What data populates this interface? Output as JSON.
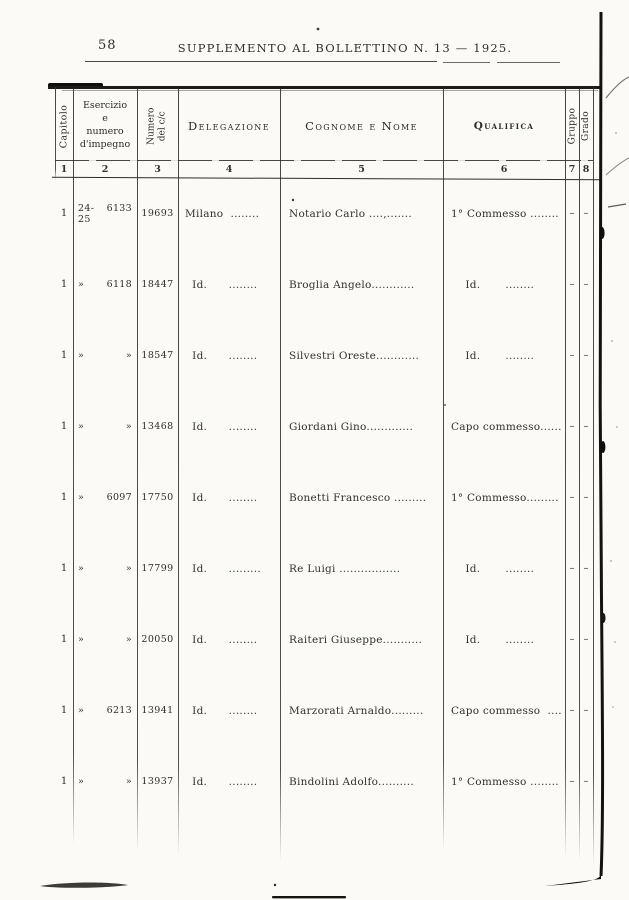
{
  "page": {
    "number": "58",
    "title": "SUPPLEMENTO AL BOLLETTINO N. 13 — 1925."
  },
  "table": {
    "headers": {
      "capitolo": "Capitolo",
      "esercizio": "Esercizio\ne\nnumero\nd'impegno",
      "numero": "Numero\ndel c/c",
      "delegazione": "Delegazione",
      "cognome": "Cognome e Nome",
      "qualifica": "Qualifica",
      "gruppo": "Gruppo",
      "grado": "Grado"
    },
    "col_numbers": [
      "1",
      "2",
      "3",
      "4",
      "5",
      "6",
      "7",
      "8"
    ],
    "rows": [
      {
        "capitolo": "1",
        "e1": "24-25",
        "e2": "6133",
        "numero": "19693",
        "delegazione": "Milano  ........",
        "cognome": "Notario Carlo ....,.......",
        "qualifica": "1° Commesso ........",
        "gruppo": "–",
        "grado": "–"
      },
      {
        "capitolo": "1",
        "e1": "»",
        "e2": "6118",
        "numero": "18447",
        "delegazione": "  Id.      ........",
        "cognome": "Broglia Angelo............",
        "qualifica": "    Id.       ........",
        "gruppo": "–",
        "grado": "–"
      },
      {
        "capitolo": "1",
        "e1": "»",
        "e2": "»",
        "numero": "18547",
        "delegazione": "  Id.      ........",
        "cognome": "Silvestri Oreste............",
        "qualifica": "    Id.       ........",
        "gruppo": "–",
        "grado": "–"
      },
      {
        "capitolo": "1",
        "e1": "»",
        "e2": "»",
        "numero": "13468",
        "delegazione": "  Id.      ........",
        "cognome": "Giordani Gino.............",
        "qualifica": "Capo commesso......",
        "gruppo": "–",
        "grado": "–"
      },
      {
        "capitolo": "1",
        "e1": "»",
        "e2": "6097",
        "numero": "17750",
        "delegazione": "  Id.      ........",
        "cognome": "Bonetti Francesco .........",
        "qualifica": "1° Commesso.........",
        "gruppo": "–",
        "grado": "–"
      },
      {
        "capitolo": "1",
        "e1": "»",
        "e2": "»",
        "numero": "17799",
        "delegazione": "  Id.      .........",
        "cognome": "Re Luigi .................",
        "qualifica": "    Id.       ........",
        "gruppo": "–",
        "grado": "–"
      },
      {
        "capitolo": "1",
        "e1": "»",
        "e2": "»",
        "numero": "20050",
        "delegazione": "  Id.      ........",
        "cognome": "Raiteri Giuseppe...........",
        "qualifica": "    Id.       ........",
        "gruppo": "–",
        "grado": "–"
      },
      {
        "capitolo": "1",
        "e1": "»",
        "e2": "6213",
        "numero": "13941",
        "delegazione": "  Id.      ........",
        "cognome": "Marzorati Arnaldo.........",
        "qualifica": "Capo commesso  ....",
        "gruppo": "–",
        "grado": "–"
      },
      {
        "capitolo": "1",
        "e1": "»",
        "e2": "»",
        "numero": "13937",
        "delegazione": "  Id.      ........",
        "cognome": "Bindolini Adolfo..........",
        "qualifica": "1° Commesso ........",
        "gruppo": "–",
        "grado": "–"
      }
    ]
  }
}
